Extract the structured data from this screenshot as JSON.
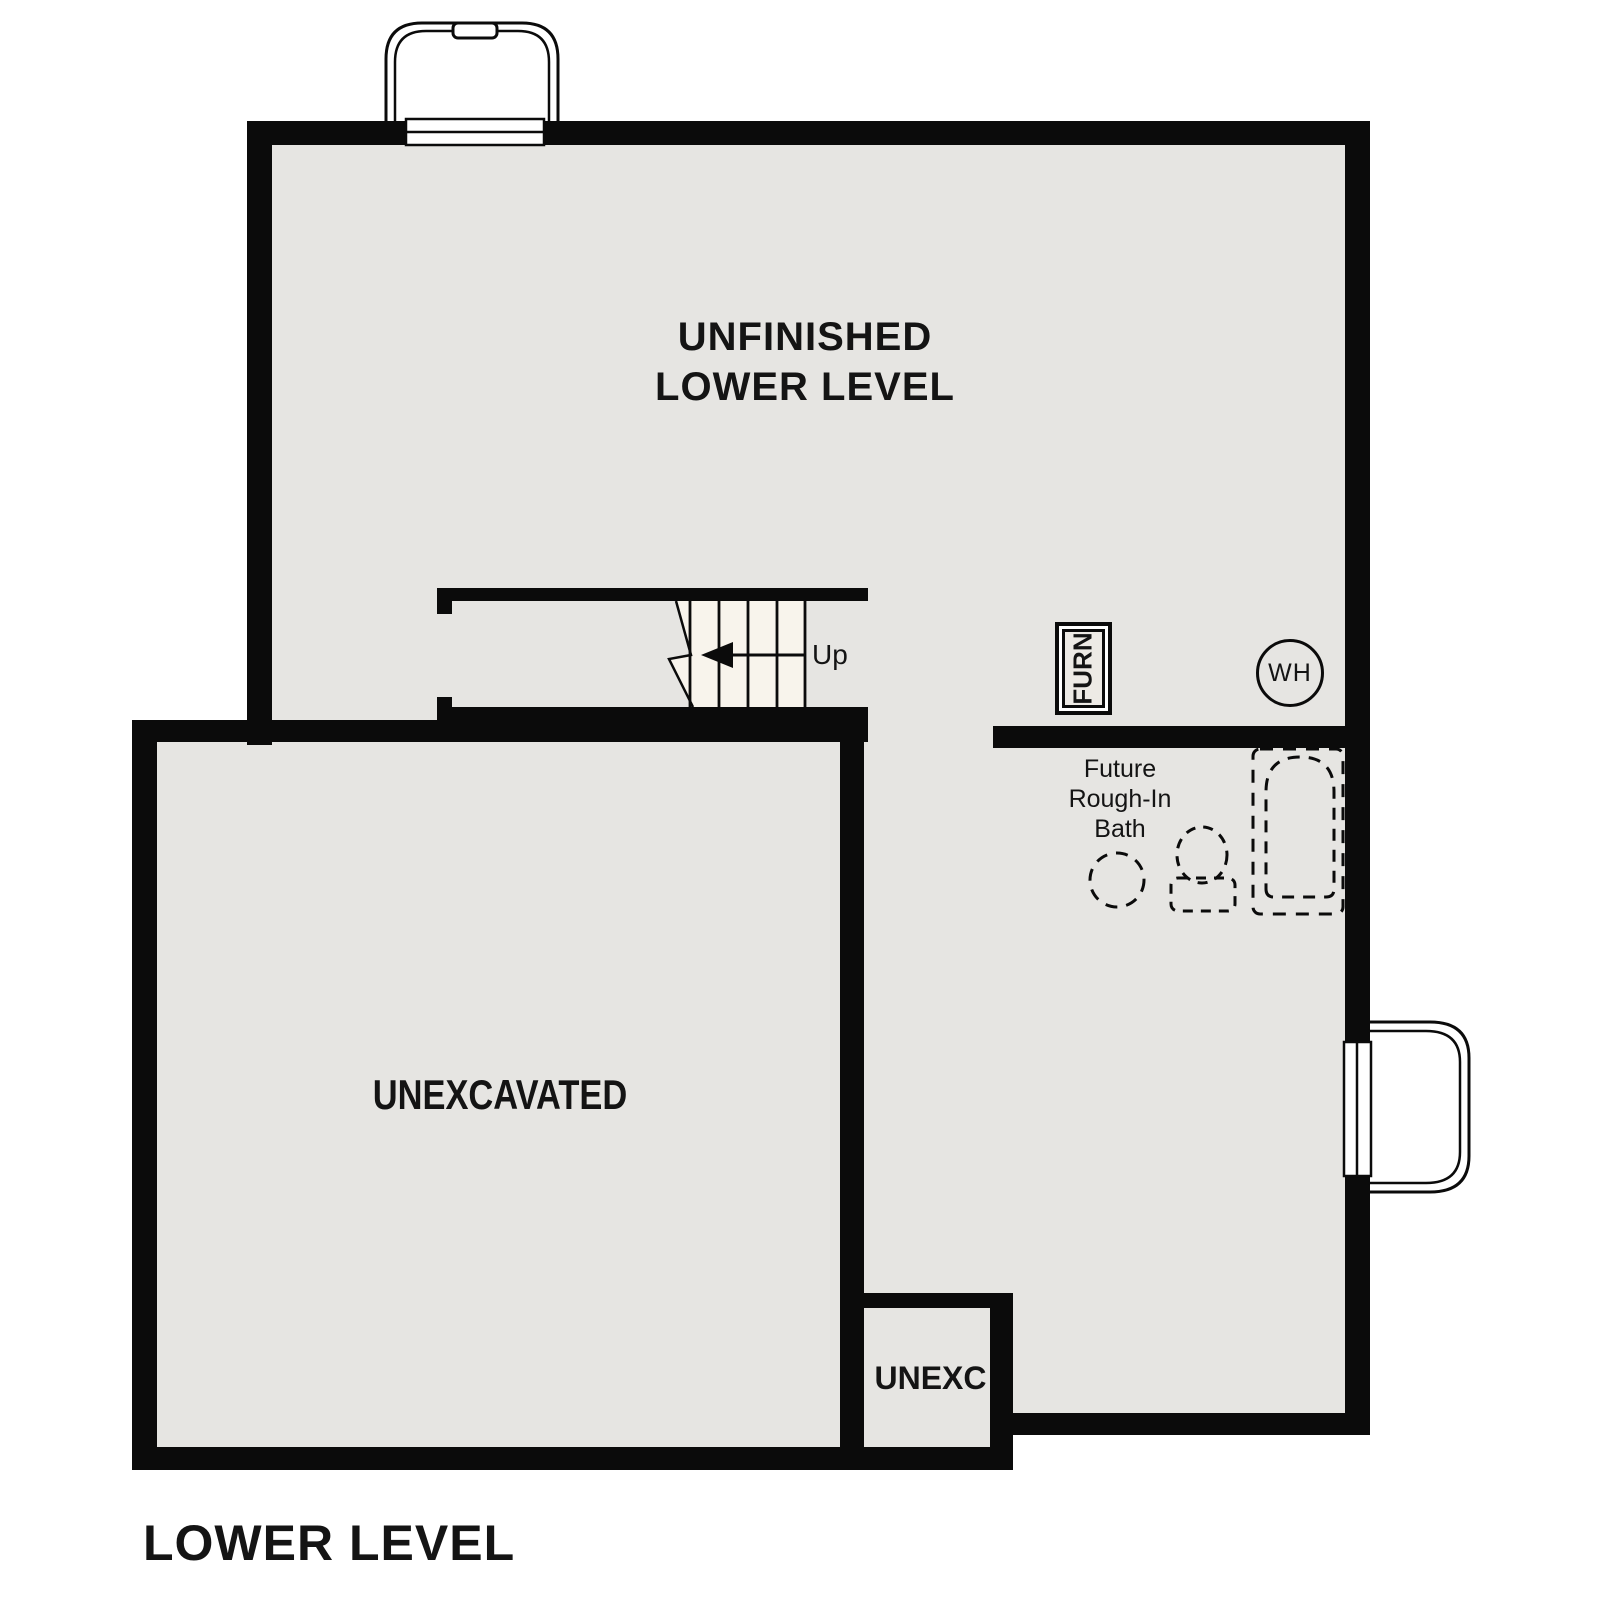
{
  "plan": {
    "title": "LOWER LEVEL"
  },
  "rooms": {
    "unfinished_lower_level": {
      "label_line1": "UNFINISHED",
      "label_line2": "LOWER LEVEL"
    },
    "unexcavated": {
      "label": "UNEXCAVATED"
    },
    "unexc_small": {
      "label": "UNEXC"
    },
    "future_bath": {
      "label_line1": "Future",
      "label_line2": "Rough-In",
      "label_line3": "Bath"
    }
  },
  "stairs": {
    "direction_label": "Up"
  },
  "equipment": {
    "furnace_label": "FURN",
    "water_heater_label": "WH"
  },
  "colors": {
    "wall": "#0b0b0b",
    "floor": "#e6e5e2",
    "stair_fill": "#f8f4ec",
    "background": "#ffffff"
  }
}
